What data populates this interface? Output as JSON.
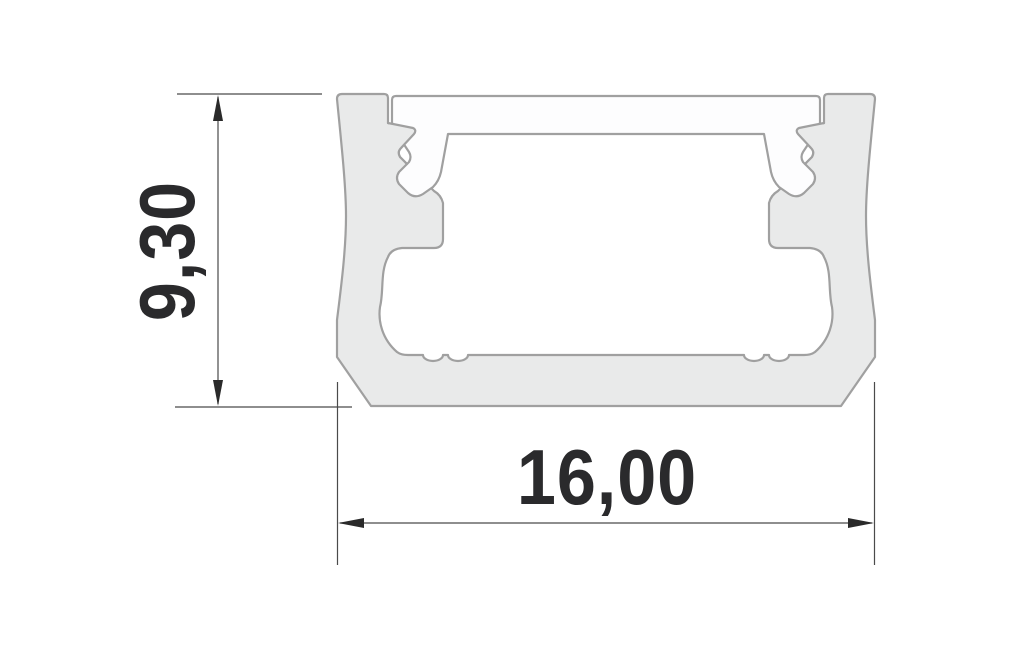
{
  "drawing": {
    "kind": "technical-cross-section",
    "dimensions": {
      "height": "9,30",
      "width": "16,00"
    },
    "colors": {
      "background": "#ffffff",
      "body_fill": "#e9eaea",
      "cover_fill": "#fdfdfe",
      "outline": "#a0a0a0",
      "dim_line": "#4a4a4a",
      "arrow_fill": "#2a2a2a",
      "text": "#2a2a2c"
    }
  }
}
